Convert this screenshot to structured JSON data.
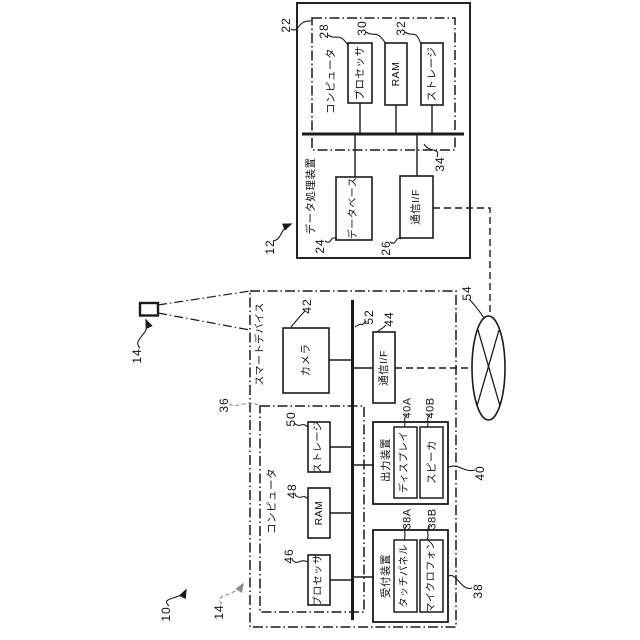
{
  "figure": {
    "system": {
      "ref": "10"
    },
    "device_icon": {
      "ref": "14"
    },
    "dpd": {
      "ref": "12",
      "title": "データ処理装置",
      "computer": {
        "ref": "22",
        "label": "コンピュータ"
      },
      "processor": {
        "ref": "28",
        "label": "プロセッサ"
      },
      "ram": {
        "ref": "30",
        "label": "RAM"
      },
      "storage": {
        "ref": "32",
        "label": "ストレージ"
      },
      "bus": {
        "ref": "34"
      },
      "database": {
        "ref": "24",
        "label": "データベース"
      },
      "comm_if": {
        "ref": "26",
        "label": "通信I/F"
      }
    },
    "smart": {
      "ref": "14",
      "title": "スマートデバイス",
      "camera": {
        "ref": "42",
        "label": "カメラ"
      },
      "bus": {
        "ref": "52"
      },
      "comm_if": {
        "ref": "44",
        "label": "通信I/F"
      },
      "computer": {
        "ref": "36",
        "label": "コンピュータ"
      },
      "storage": {
        "ref": "50",
        "label": "ストレージ"
      },
      "ram": {
        "ref": "48",
        "label": "RAM"
      },
      "processor": {
        "ref": "46",
        "label": "プロセッサ"
      },
      "output": {
        "ref": "40",
        "label": "出力装置"
      },
      "display": {
        "ref": "40A",
        "label": "ディスプレイ"
      },
      "speaker": {
        "ref": "40B",
        "label": "スピーカ"
      },
      "input": {
        "ref": "38",
        "label": "受付装置"
      },
      "touch_panel": {
        "ref": "38A",
        "label": "タッチパネル"
      },
      "microphone": {
        "ref": "38B",
        "label": "マイクロフォン"
      }
    },
    "network": {
      "ref": "54"
    },
    "colors": {
      "line": "#1a1a1a",
      "leader_gray": "#8a8a8a",
      "background": "#ffffff"
    }
  }
}
